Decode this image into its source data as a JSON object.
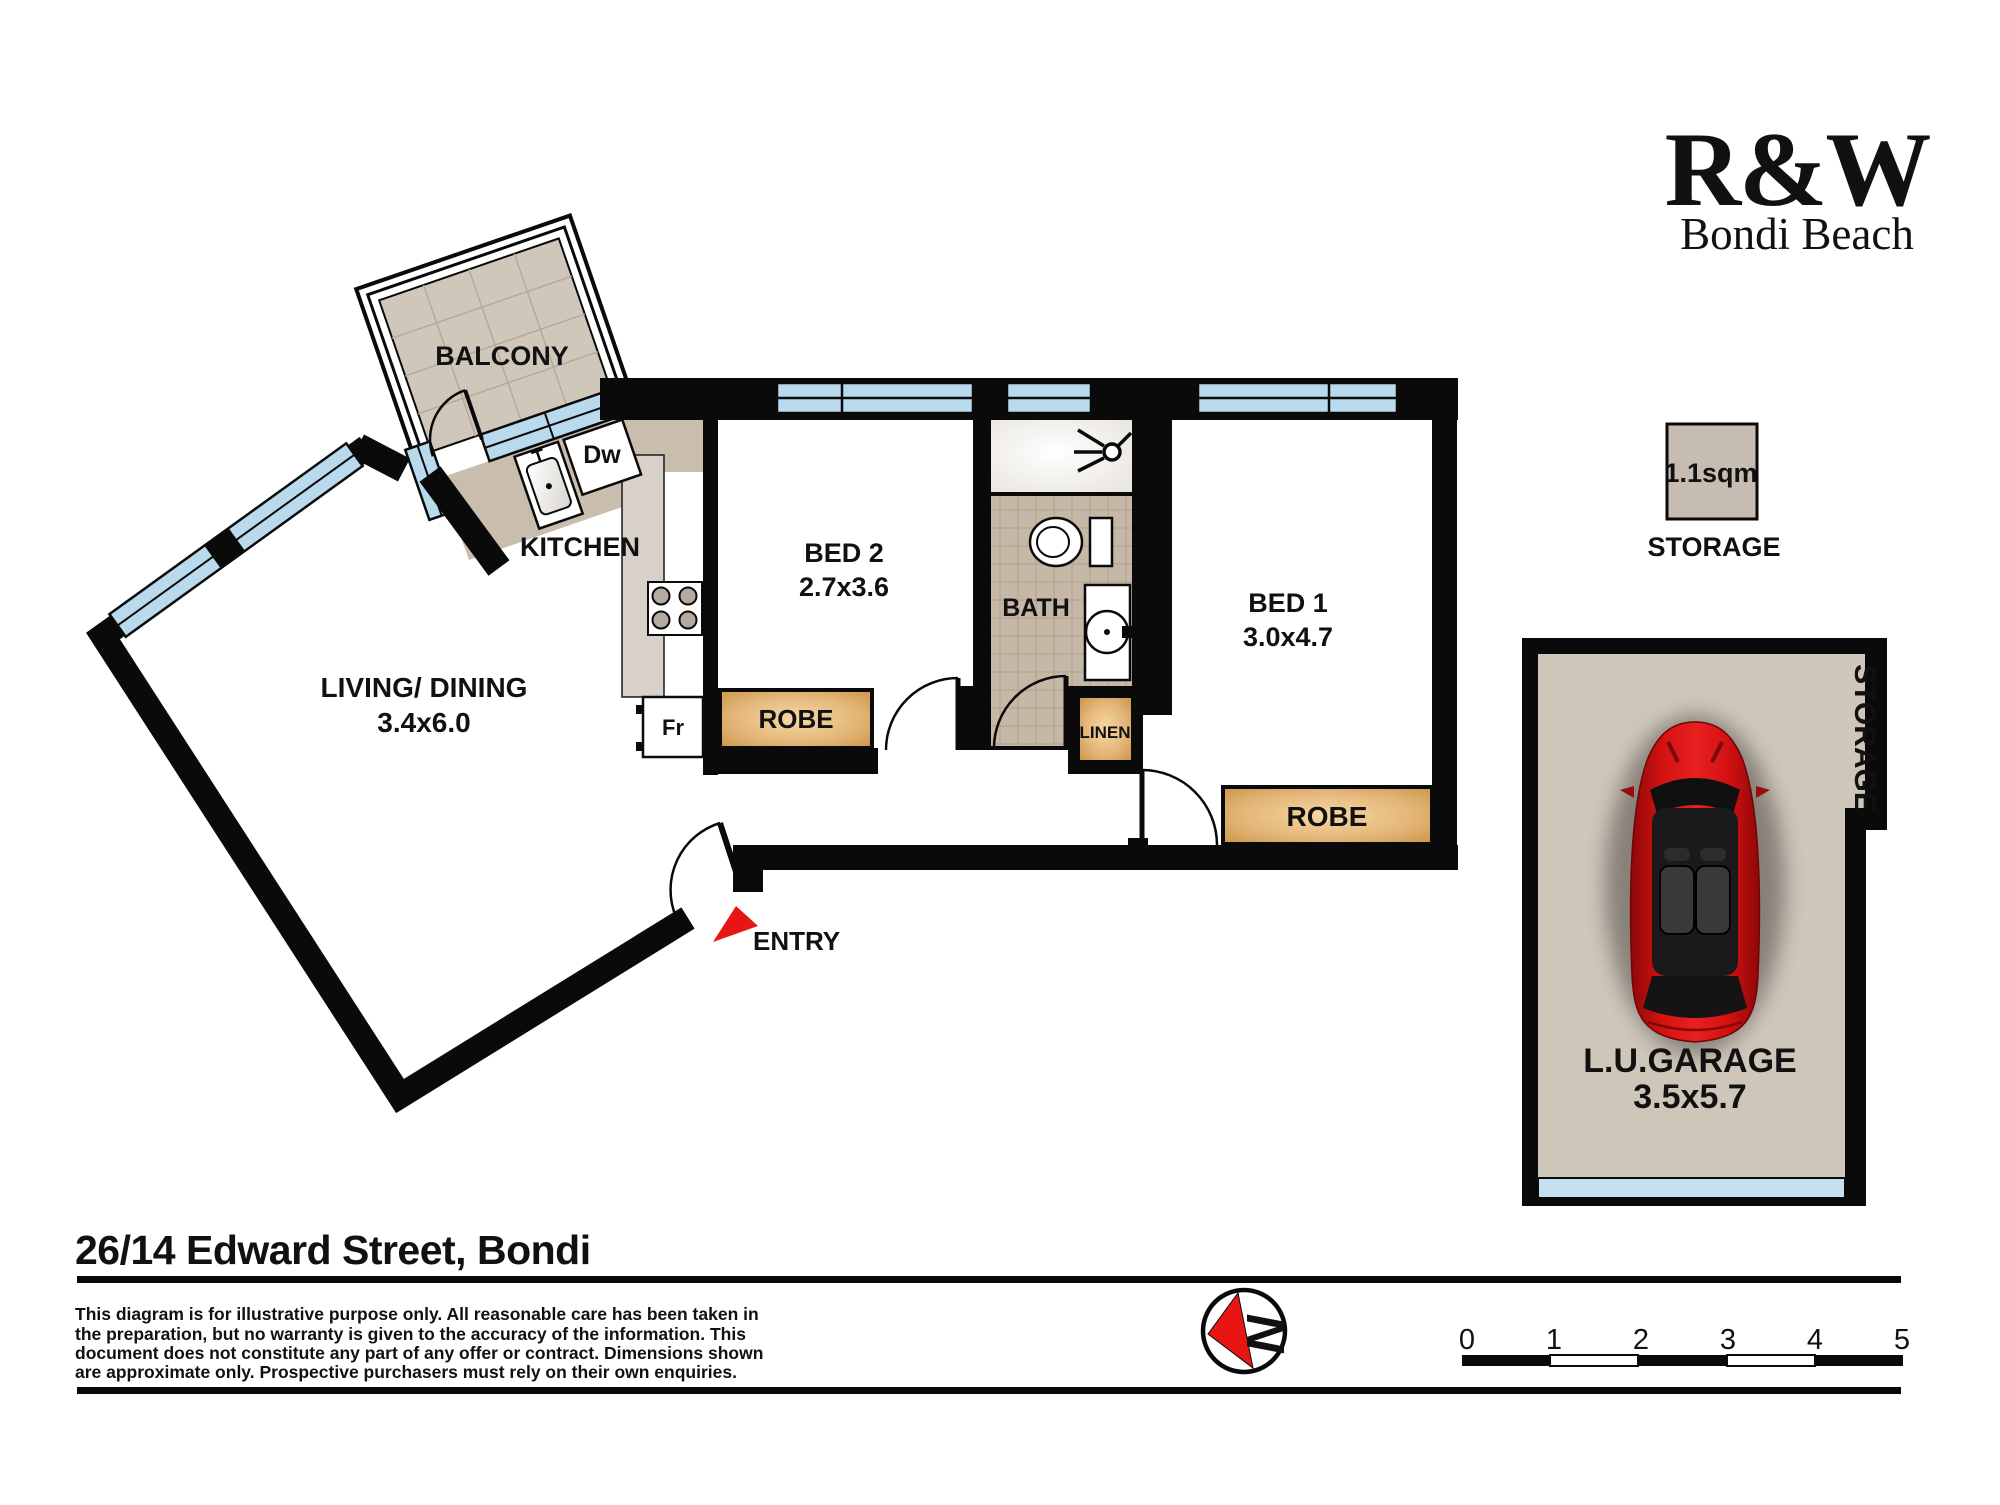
{
  "logo": {
    "brand": "R&W",
    "office": "Bondi Beach"
  },
  "plan": {
    "rooms": {
      "balcony": {
        "label": "BALCONY"
      },
      "kitchen": {
        "label": "KITCHEN"
      },
      "living": {
        "label": "LIVING/ DINING",
        "dims": "3.4x6.0"
      },
      "bed2": {
        "label": "BED 2",
        "dims": "2.7x3.6"
      },
      "bath": {
        "label": "BATH"
      },
      "bed1": {
        "label": "BED 1",
        "dims": "3.0x4.7"
      },
      "entry": {
        "label": "ENTRY"
      },
      "robe_bed2": {
        "label": "ROBE"
      },
      "robe_bed1": {
        "label": "ROBE"
      },
      "linen": {
        "label": "LINEN"
      },
      "dishwasher": {
        "label": "Dw"
      },
      "fridge": {
        "label": "Fr"
      }
    },
    "storage_unit": {
      "area": "1.1sqm",
      "label": "STORAGE"
    },
    "garage": {
      "label": "L.U.GARAGE",
      "dims": "3.5x5.7",
      "storage_label": "STORAGE"
    }
  },
  "footer": {
    "address": "26/14 Edward Street, Bondi",
    "disclaimer_lines": [
      "This diagram is for illustrative purpose only. All reasonable care has been taken in",
      "the preparation, but no warranty is given to the accuracy of the information. This",
      "document does not constitute any part of any offer or contract. Dimensions shown",
      "are approximate only. Prospective purchasers must rely on their own enquiries."
    ],
    "compass": {
      "letter": "N"
    },
    "scale": {
      "ticks": [
        "0",
        "1",
        "2",
        "3",
        "4",
        "5"
      ]
    }
  },
  "colors": {
    "brand_red": "#e1183a",
    "arrow_red": "#e81515",
    "window_blue": "#b9d9ec",
    "tile_tan": "#d0c7bb",
    "bath_tan": "#c6b8a6",
    "robe_orange": "#d79a4e",
    "wall_black": "#0a0a0a",
    "car_red": "#c50f0f"
  }
}
